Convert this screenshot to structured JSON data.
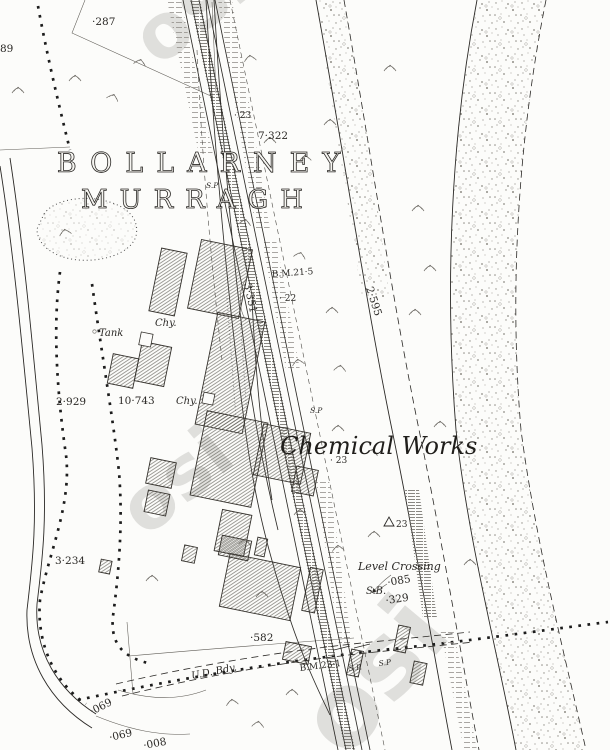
{
  "colors": {
    "paper": "#fcfcfa",
    "ink": "#2b2926",
    "inklight": "#8d8a84",
    "hatch": "#55524b",
    "stipple": "#8f8c85",
    "watermark": "#cdccc9",
    "dots": "#1c1c1c"
  },
  "townland": {
    "line1": "BOLLARNEY",
    "line2": "MURRAGH"
  },
  "features": {
    "chemical_works": "Chemical Works",
    "level_crossing": "Level Crossing",
    "signal_box": "S.B.",
    "tank": "Tank",
    "chimney_upper": "Chy.",
    "chimney_lower": "Chy.",
    "urban_district_boundary": "U.D. Bdy.",
    "signal_post_upper": "S.P",
    "signal_post_mid": "S.P",
    "signal_post_lower_1": "S.P.",
    "signal_post_lower_2": "S.P"
  },
  "benchmarks": {
    "upper": "B.M.21·5",
    "lower": "B.M.23·1"
  },
  "levels": {
    "l287": "·287",
    "l89": "89",
    "l23_upper": "· 23",
    "l7322": "7·322",
    "l22": "· 22",
    "l3351": "3·351",
    "l2595": "2·595",
    "l10743": "10·743",
    "l2929": "2·929",
    "l23_mid": "· 23",
    "trig": "23",
    "l3234": "3·234",
    "l085": "·085",
    "l329": "·329",
    "l582": "·582",
    "l069_a": "·069",
    "l069_b": "·069",
    "l008": "·008"
  },
  "watermark": {
    "text": "osi"
  }
}
